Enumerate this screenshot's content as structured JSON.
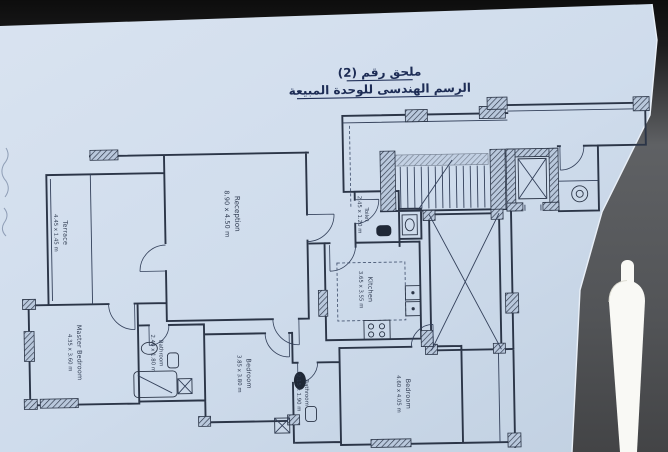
{
  "title": {
    "line1": "ملحق رقم (2)",
    "line2": "الرسم الهندسى للوحدة المبيعة"
  },
  "rooms": [
    {
      "id": "reception",
      "name": "Reception",
      "dims": "8.90 x 4.50 m"
    },
    {
      "id": "terrace",
      "name": "Terrace",
      "dims": "4.45 x 1.45 m"
    },
    {
      "id": "master-bedroom",
      "name": "Master Bedroom",
      "dims": "4.35 x 3.60 m"
    },
    {
      "id": "master-bathroom",
      "name": "Bathroom",
      "dims": "2.40 x 1.80 m"
    },
    {
      "id": "bedroom-2",
      "name": "Bedroom",
      "dims": "3.85 x 3.80 m"
    },
    {
      "id": "bathroom-2",
      "name": "Bathroom",
      "dims": "2.15 x 1.90 m"
    },
    {
      "id": "kitchen",
      "name": "Kitchen",
      "dims": "3.65 x 3.55 m"
    },
    {
      "id": "toilet",
      "name": "Toilet",
      "dims": "2.45 x 1.20 m"
    },
    {
      "id": "bedroom-3",
      "name": "Bedroom",
      "dims": "4.60 x 4.05 m"
    }
  ],
  "colors": {
    "paper": "#cfdcec",
    "ink": "#2b3547",
    "title_ink": "#1d2c55",
    "table_dark": "#0d0d0d",
    "table_gray": "#58595b",
    "pen": "#f9f9f5"
  }
}
